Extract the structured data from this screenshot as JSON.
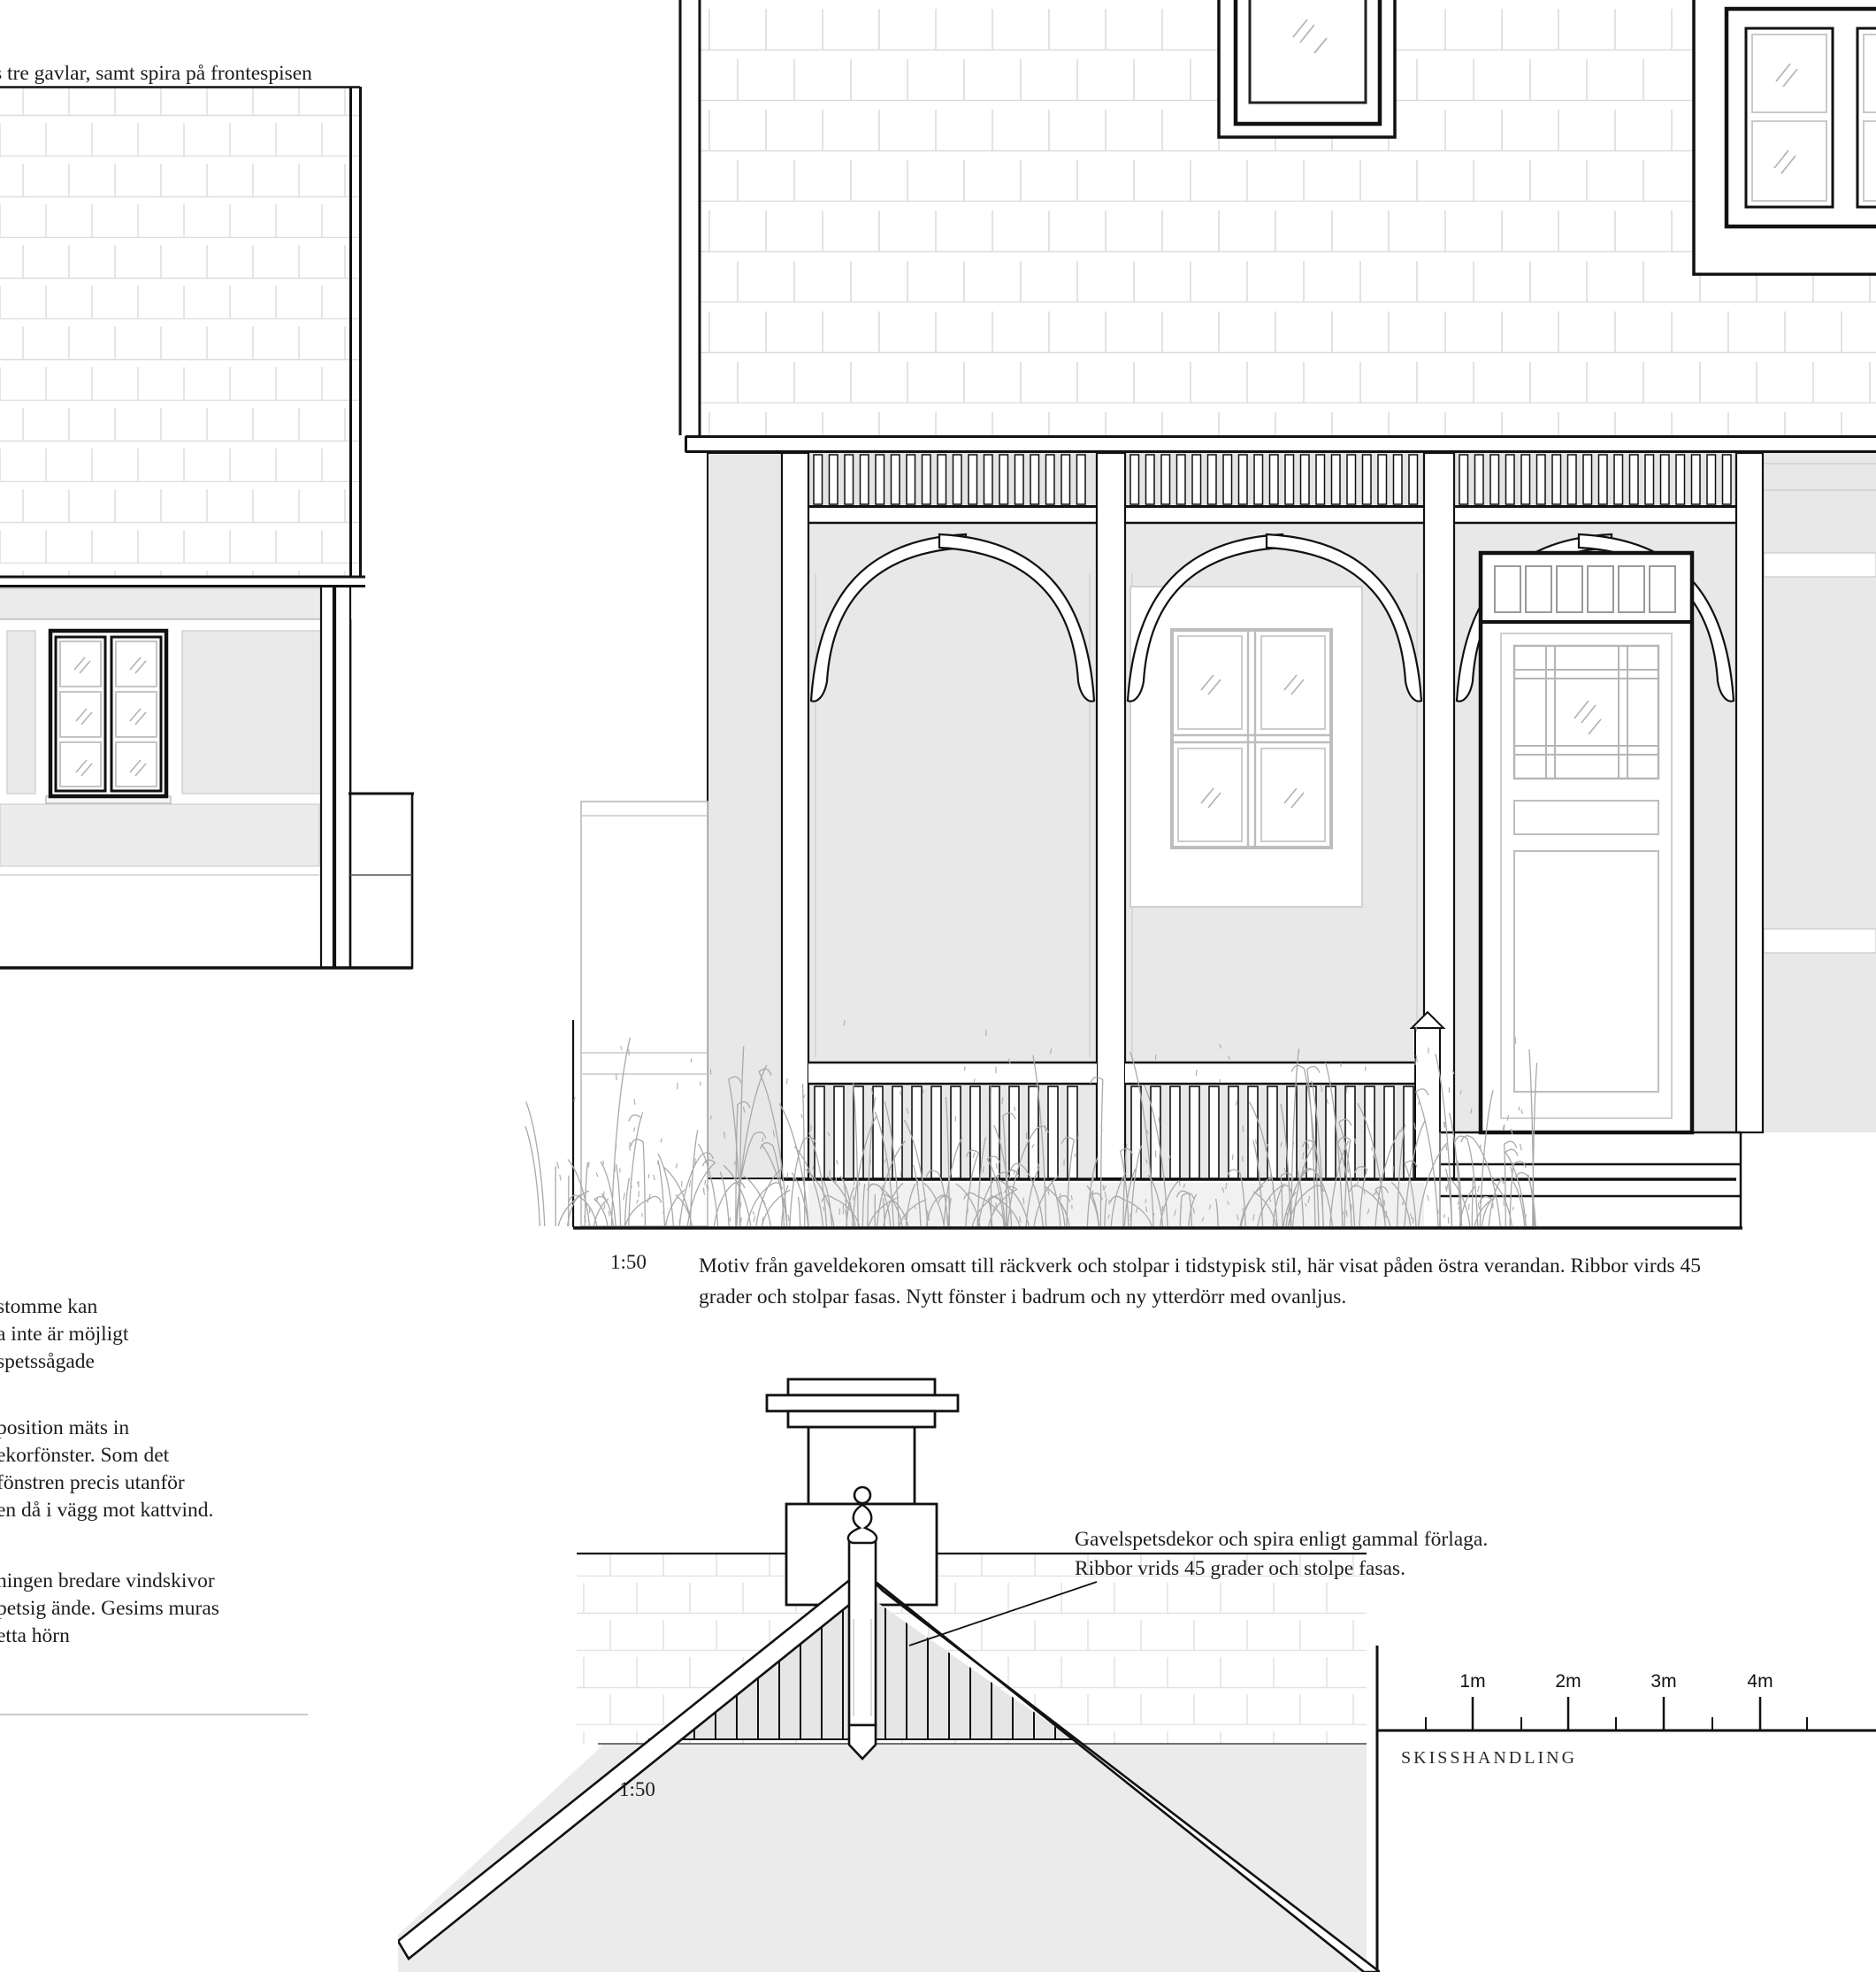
{
  "page": {
    "top_note": "s tre gavlar, samt spira på frontespisen"
  },
  "notes": {
    "block1": {
      "l1": "stomme kan",
      "l2": "a inte är möjligt",
      "l3": "spetssågade"
    },
    "block2": {
      "l1": "position mäts in",
      "l2": "ekorfönster. Som det",
      "l3": "fönstren precis utanför",
      "l4": "en då i vägg mot kattvind."
    },
    "block3": {
      "l1": "ningen bredare vindskivor",
      "l2": "petsig ände. Gesims muras",
      "l3": "etta hörn"
    }
  },
  "veranda": {
    "scale_label": "1:50",
    "caption_line1": "Motiv från gaveldekoren omsatt till räckverk och stolpar i tidstypisk stil, här visat påden östra verandan. Ribbor virds 45",
    "caption_line2": "grader och stolpar fasas. Nytt fönster i badrum och ny ytterdörr med ovanljus."
  },
  "gable": {
    "scale_label": "1:50",
    "annotation_line1": "Gavelspetsdekor och spira enligt gammal förlaga.",
    "annotation_line2": "Ribbor vrids 45 grader och stolpe fasas."
  },
  "title_block": {
    "label": "SKISSHANDLING"
  },
  "scale_bar": {
    "tick1": "1m",
    "tick2": "2m",
    "tick3": "3m",
    "tick4": "4m"
  },
  "colors": {
    "line": "#111111",
    "wall_gray": "#e8e8e8",
    "shingle_line": "#dcdcdc",
    "grass": "#a9a9a9",
    "floor_gray": "#ebebeb"
  }
}
